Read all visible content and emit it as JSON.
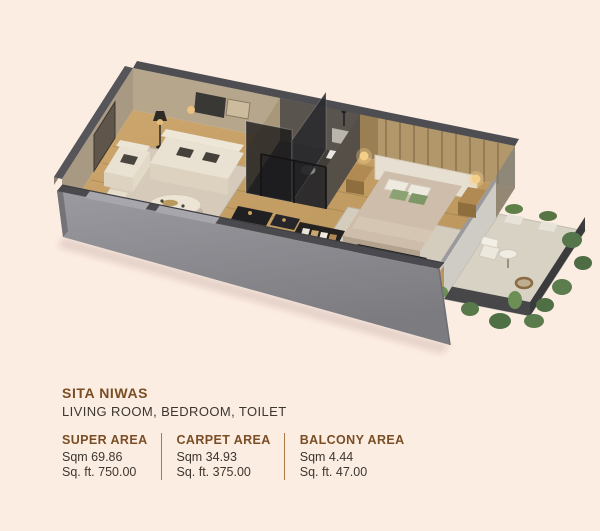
{
  "details": {
    "title": "SITA NIWAS",
    "subtitle": "LIVING ROOM, BEDROOM, TOILET",
    "areas": [
      {
        "label": "SUPER AREA",
        "sqm": "Sqm 69.86",
        "sqft": "Sq. ft. 750.00"
      },
      {
        "label": "CARPET AREA",
        "sqm": "Sqm 34.93",
        "sqft": "Sq. ft. 375.00"
      },
      {
        "label": "BALCONY AREA",
        "sqm": "Sqm 4.44",
        "sqft": "Sq. ft. 47.00"
      }
    ]
  },
  "plan": {
    "description": "3D isometric floor plan with living room, toilet, bedroom and balcony",
    "palette": {
      "background": "#fcede3",
      "accent_brown": "#7a4e24",
      "text_dark": "#3c362f",
      "divider_brown": "#aa7a46",
      "wall_gray": "#8d8d93",
      "wall_top_dark": "#4e4e52",
      "floor_wood": "#c7a066",
      "rug_light": "#d6d0c4",
      "balcony_tile": "#d8d2c5",
      "plant_green": "#5d7d4e",
      "sofa_cream": "#e9e2d2",
      "bed_taupe": "#cdbdaa",
      "pillow_green": "#8ba272",
      "lamp_glow": "#f3cf8a"
    }
  }
}
